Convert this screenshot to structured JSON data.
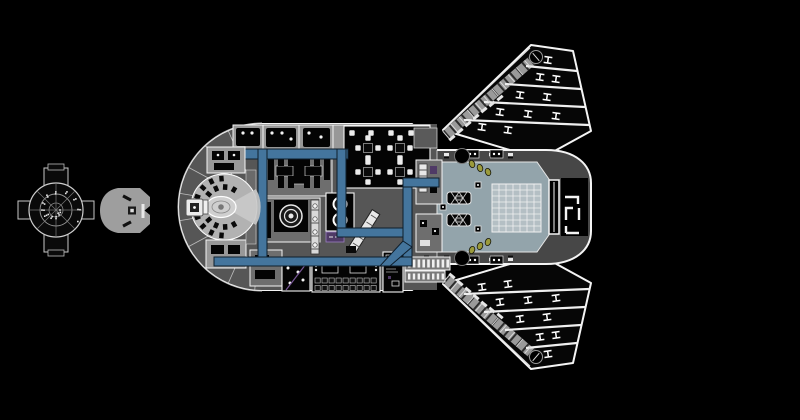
{
  "meta": {
    "description": "Black-background technical deck plan of a winged starship, with a small cross-shaped orbital-station plan thumbnail and a gray ship silhouette icon at left",
    "visible_text": []
  },
  "icons": {
    "station_thumbnail": "orbital-station-plan-icon",
    "ship_silhouette": "ship-silhouette-icon",
    "deck_plan": "starship-deck-plan",
    "reactor": "reactor-bullseye-icon",
    "bay_grid": "cargo-grid",
    "bay_doors": "stern-bay-doors"
  },
  "colors": {
    "bg": "#000000",
    "white": "#f4f4f4",
    "black": "#040404",
    "deck": "#565656",
    "deck-dark": "#474747",
    "room-light": "#989898",
    "room-mid": "#6e6e6e",
    "bridge-light": "#b2b2b2",
    "bay": "#93a4ab",
    "bay-grid-bg": "#b4bfc4",
    "corridor": "#44759d",
    "corridor-edge": "#0e1e2c",
    "olive": "#9b9b3c",
    "purple": "#4f3a66",
    "silhouette": "#9e9e9e",
    "spar": "#9a9a9a"
  },
  "params": {
    "bay_grid": {
      "x": 492,
      "y": 184,
      "cols": 7,
      "rows": 8,
      "cw": 7,
      "ch": 6
    },
    "nose": {
      "cx": 262,
      "cy": 207,
      "radials": 10,
      "a0": 95,
      "a1": 265,
      "r0": 36,
      "r1": 84,
      "rings": [
        52,
        84
      ]
    },
    "station": {
      "cx": 56,
      "cy": 210,
      "dots": 26
    },
    "mess": {
      "tables": [
        [
          368,
          148
        ],
        [
          400,
          148
        ],
        [
          368,
          172
        ],
        [
          400,
          172
        ]
      ],
      "chair_offsets": [
        [
          -10,
          0
        ],
        [
          10,
          0
        ],
        [
          0,
          -10
        ],
        [
          0,
          10
        ]
      ],
      "singles": [
        [
          352,
          133
        ],
        [
          371,
          133
        ],
        [
          391,
          133
        ],
        [
          411,
          133
        ]
      ]
    },
    "crates": {
      "x": 315,
      "y": 278,
      "cols": 9,
      "rows": 2,
      "step": 7,
      "row_step": 7.5
    },
    "radiators": [
      {
        "x": 408,
        "y": 259.5,
        "n": 9,
        "step": 4.8,
        "w": 2.6,
        "h": 8
      },
      {
        "x": 408,
        "y": 273.5,
        "n": 8,
        "step": 4.8,
        "w": 2.4,
        "h": 6
      }
    ],
    "wing": {
      "ribs": [
        [
          526,
          66,
          577,
          71
        ],
        [
          505,
          84,
          581,
          89
        ],
        [
          484,
          102,
          585,
          107
        ],
        [
          464,
          120,
          589,
          125
        ]
      ],
      "ibeams": [
        [
          548,
          60
        ],
        [
          540,
          77
        ],
        [
          556,
          79
        ],
        [
          520,
          95
        ],
        [
          547,
          97
        ],
        [
          500,
          112
        ],
        [
          528,
          114
        ],
        [
          556,
          116
        ],
        [
          482,
          127
        ],
        [
          508,
          130
        ]
      ],
      "spar": {
        "x1": 446,
        "y1": 135,
        "x2": 536,
        "y2": 57,
        "ticks": 11
      },
      "greebles": [
        [
          452,
          138
        ],
        [
          460,
          131
        ],
        [
          468,
          124
        ],
        [
          476,
          117
        ],
        [
          484,
          110
        ],
        [
          492,
          104
        ],
        [
          500,
          98
        ]
      ]
    },
    "bridge": {
      "cx": 224,
      "cy": 207,
      "inner": {
        "n": 10,
        "r": 20,
        "a0": 60,
        "a1": 300
      },
      "outer": {
        "n": 9,
        "r": 28.5,
        "a0": 95,
        "a1": 265
      }
    },
    "bay_side": {
      "trio": [
        [
          472,
          164
        ],
        [
          480,
          168
        ],
        [
          488,
          172
        ]
      ],
      "handles": [
        424,
        444,
        468,
        489,
        508
      ],
      "cabinets": [
        [
          466,
          150
        ],
        [
          490,
          150
        ]
      ]
    },
    "tie_downs": [
      [
        478,
        185
      ],
      [
        478,
        229
      ],
      [
        443,
        207
      ]
    ],
    "shuttles": [
      [
        459,
        198
      ],
      [
        459,
        220
      ]
    ]
  }
}
